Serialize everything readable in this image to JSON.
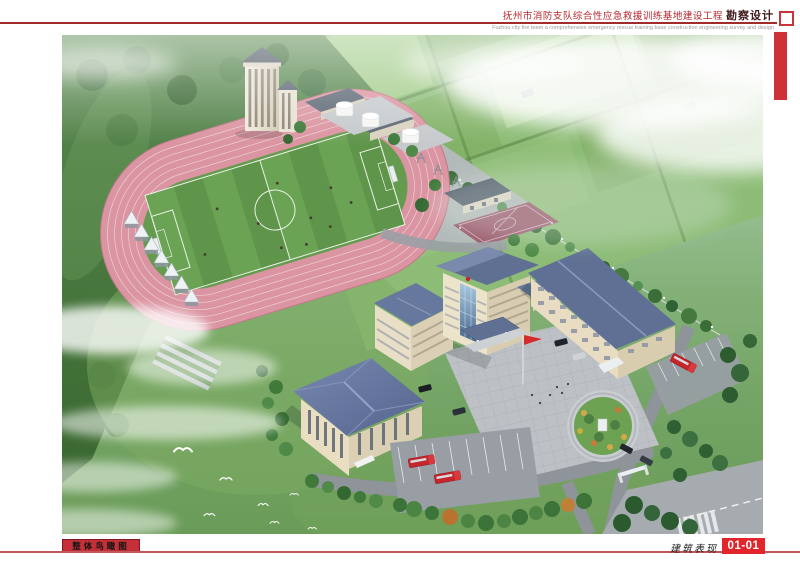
{
  "header": {
    "title_cn": "抚州市消防支队综合性应急救援训练基地建设工程",
    "title_suffix": "勘察设计",
    "subtitle_en": "Fuzhou city fire team a comprehensive emergency rescue training base construction engineering survey and design"
  },
  "footer": {
    "view_label": "整体鸟瞰图",
    "category_label": "建筑表现",
    "sheet_number": "01-01"
  },
  "colors": {
    "accent_red": "#c4262b",
    "sheet_number_red": "#e2242b",
    "title_red": "#b5262c",
    "track_pink": "#db94a1",
    "field_green": "#659b4f",
    "roof_blue_gray": "#5f7092",
    "wall_cream": "#e9dfc7",
    "road_gray": "#8e9499"
  },
  "scene": {
    "type": "architectural-aerial-rendering",
    "features": [
      "forest-hills",
      "farmland",
      "running-track",
      "soccer-field",
      "grandstand",
      "training-tower",
      "fuel-tanks",
      "basketball-courts",
      "headquarters-building",
      "gymnasium",
      "dormitory-building",
      "flag-plaza",
      "circular-garden",
      "fire-trucks",
      "parking-lots",
      "perimeter-fence",
      "clouds",
      "egrets"
    ]
  }
}
